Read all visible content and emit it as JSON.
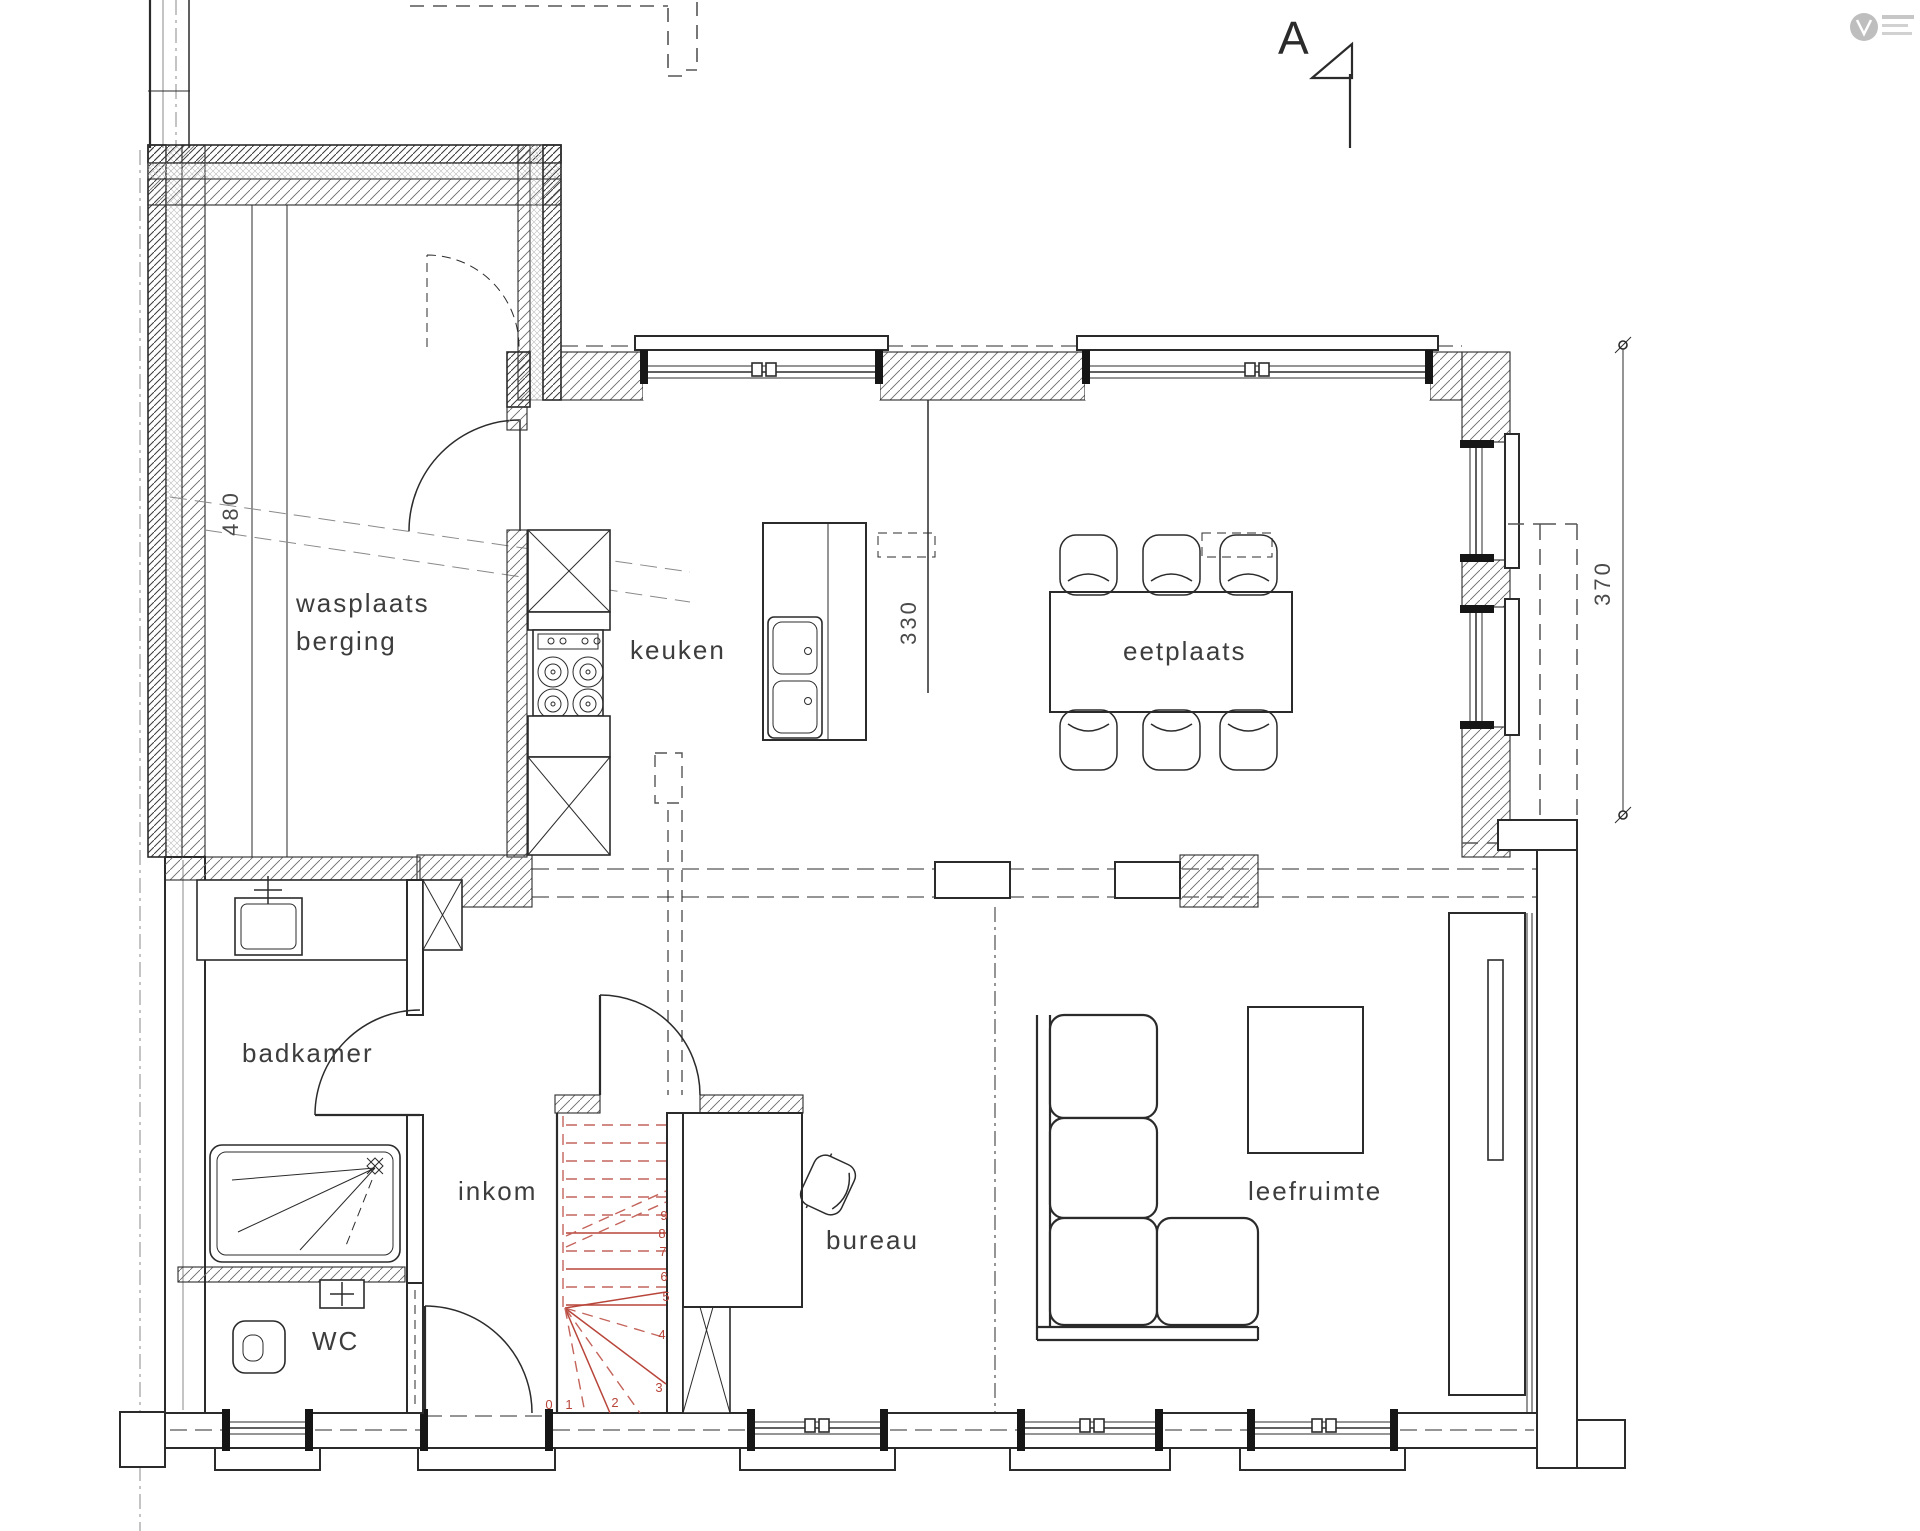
{
  "drawing": {
    "section_marker": "A"
  },
  "rooms": {
    "wasplaats": {
      "line1": "wasplaats",
      "line2": "berging"
    },
    "keuken": {
      "label": "keuken"
    },
    "eetplaats": {
      "label": "eetplaats"
    },
    "badkamer": {
      "label": "badkamer"
    },
    "inkom": {
      "label": "inkom"
    },
    "wc": {
      "label": "WC"
    },
    "bureau": {
      "label": "bureau"
    },
    "leefruimte": {
      "label": "leefruimte"
    }
  },
  "dimensions": {
    "left_vertical": "480",
    "kitchen_vertical": "330",
    "right_vertical": "370"
  },
  "stairs": {
    "steps": [
      "0",
      "1",
      "2",
      "3",
      "4",
      "5",
      "6",
      "7",
      "8",
      "9"
    ]
  },
  "colors": {
    "line": "#2b2b2b",
    "label": "#3d3d3d",
    "stair_red": "#b8453a",
    "dashed_gray": "#555555",
    "logo_gray": "#9a9a9a"
  }
}
